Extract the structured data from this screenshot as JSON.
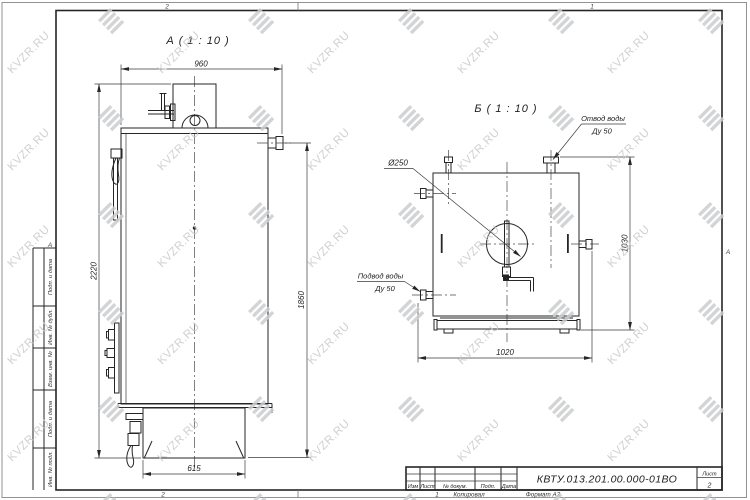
{
  "watermark": {
    "text": "KVZR.RU",
    "logo": "kvzr-stripes-logo"
  },
  "frame": {
    "zone_top_left": "2",
    "zone_top_right": "1",
    "zone_bottom_left": "2",
    "zone_letter_left": "А",
    "zone_letter_right": "А",
    "left_column_labels": [
      "Подп. и дата",
      "Инв. № дубл.",
      "Взам. инв. №",
      "Подп. и дата",
      "Инв. № подл."
    ],
    "footer": {
      "page_mark": "1",
      "copied_label": "Копировал",
      "format_label": "Формат А3"
    }
  },
  "title_block": {
    "columns": [
      "Изм",
      "Лист",
      "№ докум.",
      "Подп.",
      "Дата"
    ],
    "designation": "КВТУ.013.201.00.000-01ВО",
    "sheet_label": "Лист",
    "sheet_number": "2"
  },
  "views": {
    "a": {
      "title": "А ( 1 : 10 )",
      "dims": {
        "top_width": "960",
        "left_height": "2220",
        "right_height": "1860",
        "base_width": "615"
      }
    },
    "b": {
      "title": "Б ( 1 : 10 )",
      "dims": {
        "bottom_width": "1020",
        "right_height": "1030",
        "diameter": "Ø250"
      },
      "labels": {
        "outlet_line1": "Отвод воды",
        "outlet_line2": "Ду 50",
        "inlet_line1": "Подвод воды",
        "inlet_line2": "Ду 50"
      }
    }
  }
}
